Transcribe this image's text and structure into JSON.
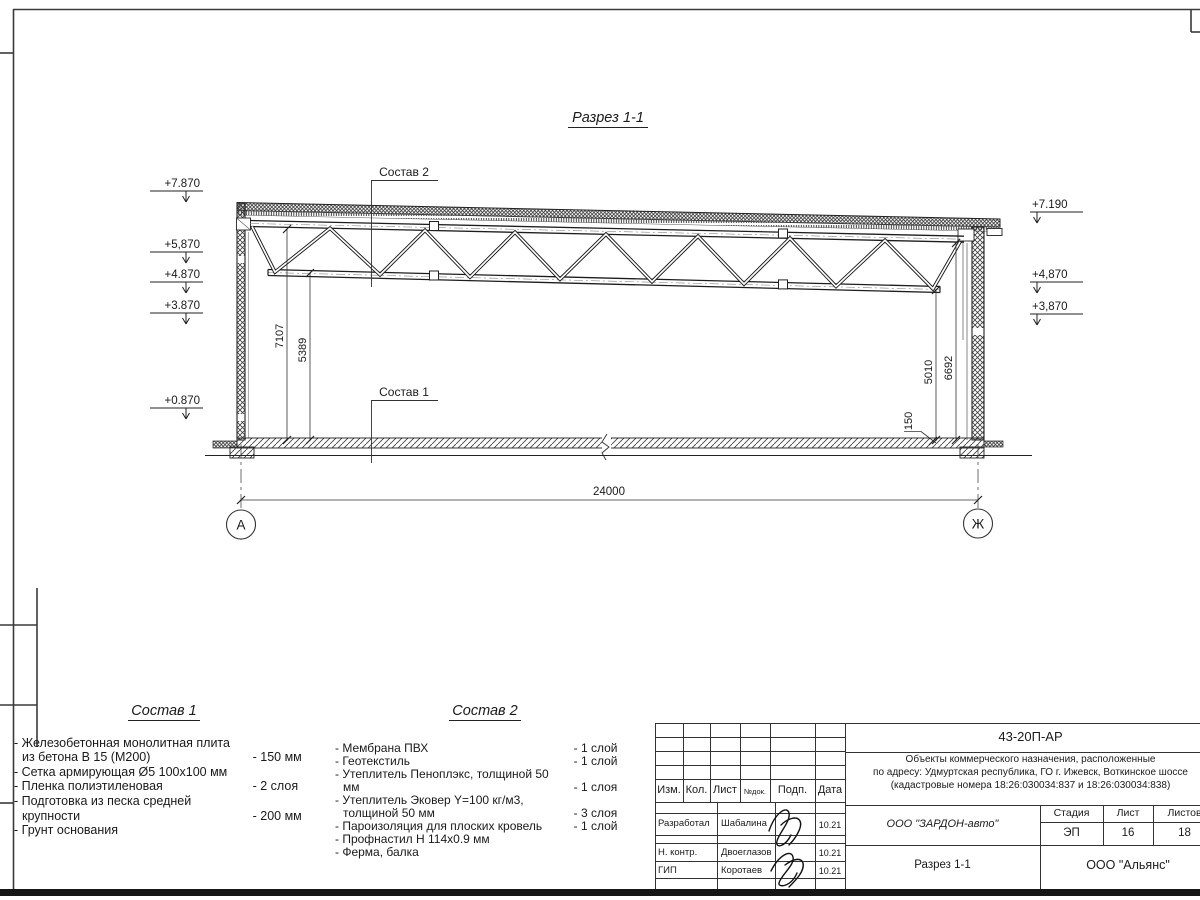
{
  "drawing": {
    "title": "Разрез 1-1",
    "elevations_left": [
      "+7.870",
      "+5,870",
      "+4.870",
      "+3.870",
      "+0.870"
    ],
    "elevations_right": [
      "+7.190",
      "+4,870",
      "+3,870"
    ],
    "dim_span": "24000",
    "dim_left_outer": "7107",
    "dim_left_inner": "5389",
    "dim_right_inner": "5010",
    "dim_right_outer": "6692",
    "dim_slab": "150",
    "axis_left": "А",
    "axis_right": "Ж",
    "callout_roof": "Состав 2",
    "callout_floor": "Состав 1"
  },
  "comp1": {
    "title": "Состав 1",
    "items": [
      {
        "name": "- Железобетонная  монолитная плита из бетона В 15 (М200)",
        "value": "- 150 мм"
      },
      {
        "name": "- Сетка армирующая Ø5 100х100 мм",
        "value": ""
      },
      {
        "name": "- Пленка полиэтиленовая",
        "value": "-  2 слоя"
      },
      {
        "name": "- Подготовка из песка средней крупности",
        "value": "- 200 мм"
      },
      {
        "name": "- Грунт основания",
        "value": ""
      }
    ]
  },
  "comp2": {
    "title": "Состав 2",
    "items": [
      {
        "name": "- Мембрана ПВХ",
        "value": "- 1 слой"
      },
      {
        "name": "- Геотекстиль",
        "value": "- 1 слой"
      },
      {
        "name": "- Утеплитель Пеноплэкс, толщиной 50 мм",
        "value": "- 1 слоя"
      },
      {
        "name": "- Утеплитель Эковер Y=100 кг/м3, толщиной 50 мм",
        "value": "- 3 слоя"
      },
      {
        "name": "- Пароизоляция для плоских кровель",
        "value": "- 1 слой"
      },
      {
        "name": "- Профнастил Н 114х0.9 мм",
        "value": ""
      },
      {
        "name": "- Ферма, балка",
        "value": ""
      }
    ]
  },
  "stamp": {
    "doc_code": "43-20П-АР",
    "address_line1": "Объекты коммерческого назначения, расположенные",
    "address_line2": "по адресу: Удмуртская республика, ГО г. Ижевск, Воткинское шоссе",
    "address_line3": "(кадастровые номера 18:26:030034:837 и 18:26:030034:838)",
    "col_izm": "Изм.",
    "col_kol": "Кол.",
    "col_list": "Лист",
    "col_ndoc": "№док.",
    "col_podp": "Подп.",
    "col_data": "Дата",
    "row1_role": "Разработал",
    "row1_name": "Шабалина",
    "row1_date": "10.21",
    "row2_role": "Н. контр.",
    "row2_name": "Двоеглазов",
    "row2_date": "10.21",
    "row3_role": "ГИП",
    "row3_name": "Коротаев",
    "row3_date": "10.21",
    "org_project": "ООО \"ЗАРДОН-авто\"",
    "stage_label": "Стадия",
    "sheet_label": "Лист",
    "sheets_label": "Листов",
    "stage": "ЭП",
    "sheet_no": "16",
    "sheets_total": "18",
    "section_title": "Разрез 1-1",
    "org": "ООО \"Альянс\""
  }
}
